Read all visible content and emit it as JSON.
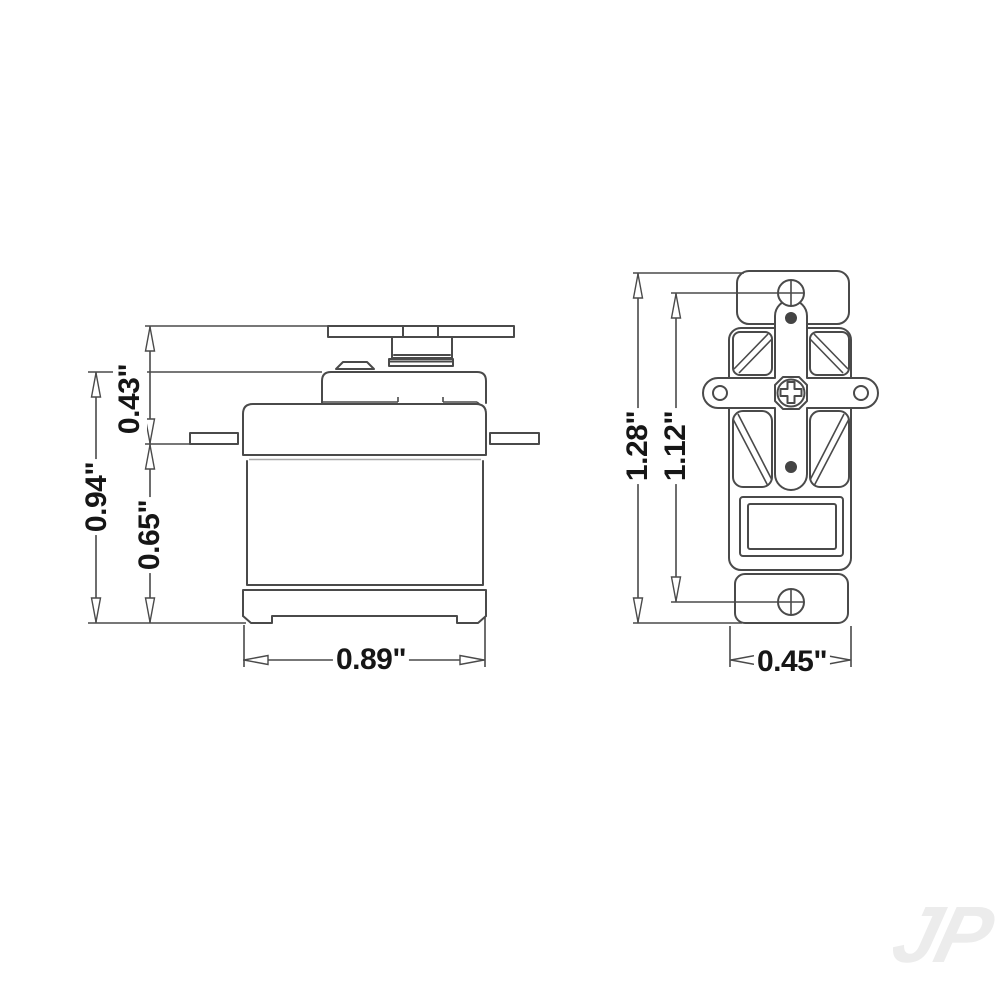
{
  "colors": {
    "line": "#4a4a4a",
    "line_light": "#a8a8a8",
    "text": "#161616",
    "background": "#ffffff",
    "watermark": "#ececec"
  },
  "side_view": {
    "dim_horn_to_flange": "0.43\"",
    "dim_overall_height": "0.94\"",
    "dim_flange_to_bottom": "0.65\"",
    "dim_body_width": "0.89\""
  },
  "top_view": {
    "dim_overall_length": "1.28\"",
    "dim_mount_hole_spacing": "1.12\"",
    "dim_body_width": "0.45\""
  },
  "watermark": {
    "text": "JP"
  }
}
